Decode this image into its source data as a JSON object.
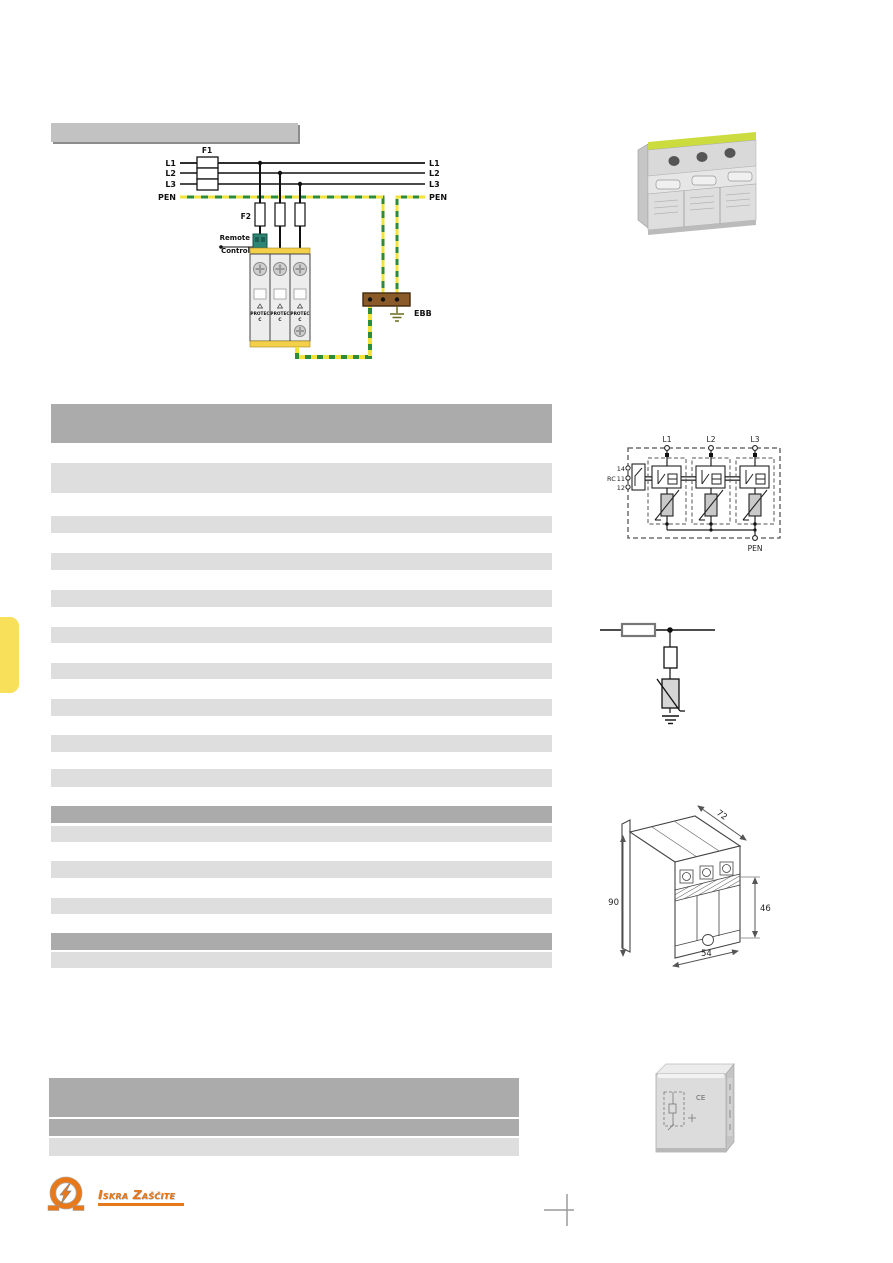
{
  "wiring": {
    "title_bar_text": "",
    "phases_left": [
      "L1",
      "L2",
      "L3",
      "PEN"
    ],
    "phases_right": [
      "L1",
      "L2",
      "L3",
      "PEN"
    ],
    "fuse_main": "F1",
    "fuse_branch": "F2",
    "remote_line1": "Remote",
    "remote_line2": "Control",
    "earth_bar": "EBB",
    "module_name": "PROTEC",
    "module_class": "C"
  },
  "schematic": {
    "phases": [
      "L1",
      "L2",
      "L3"
    ],
    "rc_label": "RC",
    "terminals": [
      "14",
      "11",
      "12"
    ],
    "pen": "PEN"
  },
  "dims": {
    "top": "72",
    "left": "90",
    "right": "46",
    "bottom": "54"
  },
  "footer": {
    "brand": "Iskra Zaščite"
  },
  "colors": {
    "accent_orange": "#e87818",
    "pen_green": "#2e8b3a",
    "pen_yellow": "#f2e23c",
    "tab_yellow": "#f8e05a",
    "row_light": "#dedede",
    "row_dark": "#ababab",
    "title_bar_gray": "#c2c2c2",
    "device_yellow": "#f4cf4a",
    "ebb_brown": "#8a5a28"
  },
  "tables": [
    {
      "container": "spec-table",
      "left": 51,
      "width": 501,
      "rows": [
        [
          404,
          39,
          "dark"
        ],
        [
          463,
          30,
          "light"
        ],
        [
          516,
          17,
          "light"
        ],
        [
          553,
          17,
          "light"
        ],
        [
          590,
          17,
          "light"
        ],
        [
          627,
          16,
          "light"
        ],
        [
          663,
          16,
          "light"
        ],
        [
          699,
          17,
          "light"
        ],
        [
          735,
          17,
          "light"
        ],
        [
          769,
          18,
          "light"
        ],
        [
          806,
          17,
          "dark"
        ],
        [
          826,
          16,
          "light"
        ],
        [
          861,
          17,
          "light"
        ],
        [
          898,
          16,
          "light"
        ],
        [
          933,
          17,
          "dark"
        ],
        [
          952,
          16,
          "light"
        ]
      ]
    },
    {
      "container": "order-table",
      "left": 49,
      "width": 470,
      "rows": [
        [
          1078,
          39,
          "dark"
        ],
        [
          1119,
          17,
          "dark"
        ],
        [
          1138,
          18,
          "light"
        ]
      ]
    }
  ]
}
